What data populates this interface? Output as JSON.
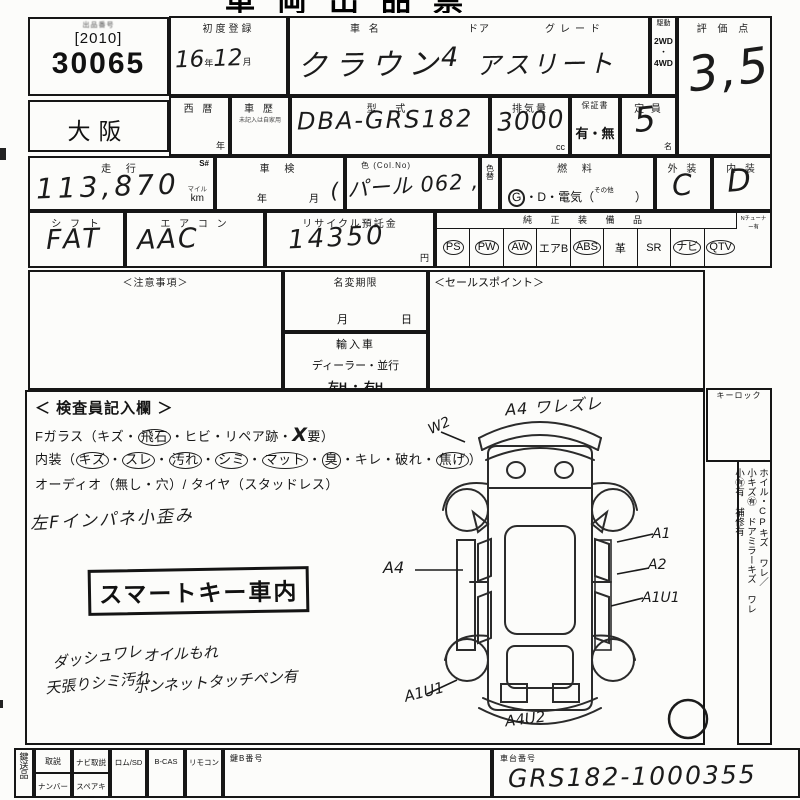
{
  "title_clipped": "車両出品票",
  "header": {
    "lot": {
      "label": "出品番号",
      "bracket": "[2010]",
      "number": "30065"
    },
    "first_reg": {
      "label": "初度登録",
      "year": "16",
      "year_unit": "年",
      "month": "12",
      "month_unit": "月"
    },
    "car_name": {
      "label": "車  名",
      "value": "クラウン"
    },
    "door": {
      "label": "ドア",
      "value": "4"
    },
    "grade": {
      "label": "グレード",
      "value": "アスリート"
    },
    "drive": {
      "label": "駆動",
      "opt1": "2WD",
      "dot": "・",
      "opt2": "4WD"
    },
    "score": {
      "label": "評 価 点",
      "value": "3,5"
    }
  },
  "row2": {
    "prefecture": "大阪",
    "seireki": {
      "label": "西  暦",
      "unit": "年"
    },
    "shareki": {
      "label": "車  歴",
      "note": "未記入は自家用"
    },
    "katashiki": {
      "label": "型  式",
      "value": "DBA-GRS182"
    },
    "displacement": {
      "label": "排気量",
      "value": "3000",
      "unit": "cc"
    },
    "warranty": {
      "label": "保証書",
      "options": "有・無"
    },
    "capacity": {
      "label": "定  員",
      "value": "5",
      "unit": "名"
    }
  },
  "row3": {
    "mileage": {
      "label": "走  行",
      "s": "S#",
      "value": "113,870",
      "unit_top": "マイル",
      "unit_bottom": "km"
    },
    "shaken": {
      "label": "車  検",
      "year": "年",
      "month": "月"
    },
    "color": {
      "label": "色 (Col.No)",
      "value": "( パール 062 ,"
    },
    "color_change": {
      "label": "色替"
    },
    "fuel": {
      "label": "燃  料",
      "g": "G",
      "mid": "・D・電気（",
      "sonota": "その他",
      "close": "）"
    },
    "exterior": {
      "label": "外 装",
      "value": "C"
    },
    "interior": {
      "label": "内 装",
      "value": "D"
    }
  },
  "row4": {
    "shift": {
      "label": "シ フ ト",
      "value": "FAT"
    },
    "aircon": {
      "label": "エ ア コ ン",
      "value": "AAC"
    },
    "recycle": {
      "label": "リサイクル預託金",
      "value": "14350",
      "unit": "円"
    },
    "equipment": {
      "label": "純 正 装 備 品",
      "right_label": "Nチューナー有",
      "items": [
        {
          "t": "PS",
          "circled": true
        },
        {
          "t": "PW",
          "circled": true
        },
        {
          "t": "AW",
          "circled": true
        },
        {
          "t": "エアB",
          "circled": false
        },
        {
          "t": "ABS",
          "circled": true
        },
        {
          "t": "革",
          "circled": false
        },
        {
          "t": "SR",
          "circled": false
        },
        {
          "t": "ナビ",
          "circled": true
        },
        {
          "t": "QTV",
          "circled": true
        }
      ]
    }
  },
  "row5": {
    "notes_label": "＜注意事項＞",
    "name_change": {
      "label": "名変期限",
      "month": "月",
      "day": "日"
    },
    "import": {
      "label": "輸入車",
      "dealer": "ディーラー・並行",
      "handle": "左H ・ 右H"
    },
    "sales_label": "＜セールスポイント＞"
  },
  "inspector": {
    "heading": "＜ 検査員記入欄 ＞",
    "fglass": {
      "pre": "Fガラス（キズ・",
      "circ": "飛石",
      "mid": "・ヒビ・リペア跡・",
      "hand": "X",
      "post": "要）"
    },
    "naiso": {
      "pre": "内装（",
      "tokens": [
        {
          "t": "キズ",
          "circled": true
        },
        {
          "t": "スレ",
          "circled": true
        },
        {
          "t": "汚れ",
          "circled": true
        },
        {
          "t": "シミ",
          "circled": true
        },
        {
          "t": "マット",
          "circled": true
        },
        {
          "t": "臭",
          "circled": true
        },
        {
          "t": "キレ",
          "circled": false
        },
        {
          "t": "破れ",
          "circled": false
        },
        {
          "t": "焦げ",
          "circled": true
        }
      ],
      "post": "）"
    },
    "audio": "オーディオ（無し・穴）/ タイヤ（スタッドレス）",
    "note_impane": "左Fインパネ小歪み",
    "stamp": "スマートキー車内",
    "note_dash": "ダッシュワレ",
    "note_tenbari": "天張りシミ汚れ",
    "note_oil": "オイルもれ",
    "note_bonnet": "ボンネットタッチペン有"
  },
  "diagram": {
    "front_bumper": "A4 ワレズレ",
    "front_left_wing": "W2",
    "left_side": "A4",
    "right_door_1": "A1",
    "right_door_2": "A2",
    "right_rear": "A1U1",
    "rear_left": "A1U1",
    "rear_bumper": "A4U2"
  },
  "right_col": {
    "keylock": "キーロック",
    "line1": "ホイル・CPキズ ワレ／",
    "line2": "小キズ㊒ ドアミラーキズ ワレ",
    "line3": "小㊒有 補修有"
  },
  "bottom": {
    "side_label": "鍵送品",
    "manual": "取説",
    "navi_manual": "ナビ取説",
    "rom": "ロム/SD",
    "bcas": "B-CAS",
    "remote": "リモコン",
    "number": "ナンバー",
    "spare_key": "スペアキー",
    "key_no": "鍵B番号",
    "chassis_label": "車台番号",
    "chassis_value": "GRS182-1000355"
  }
}
